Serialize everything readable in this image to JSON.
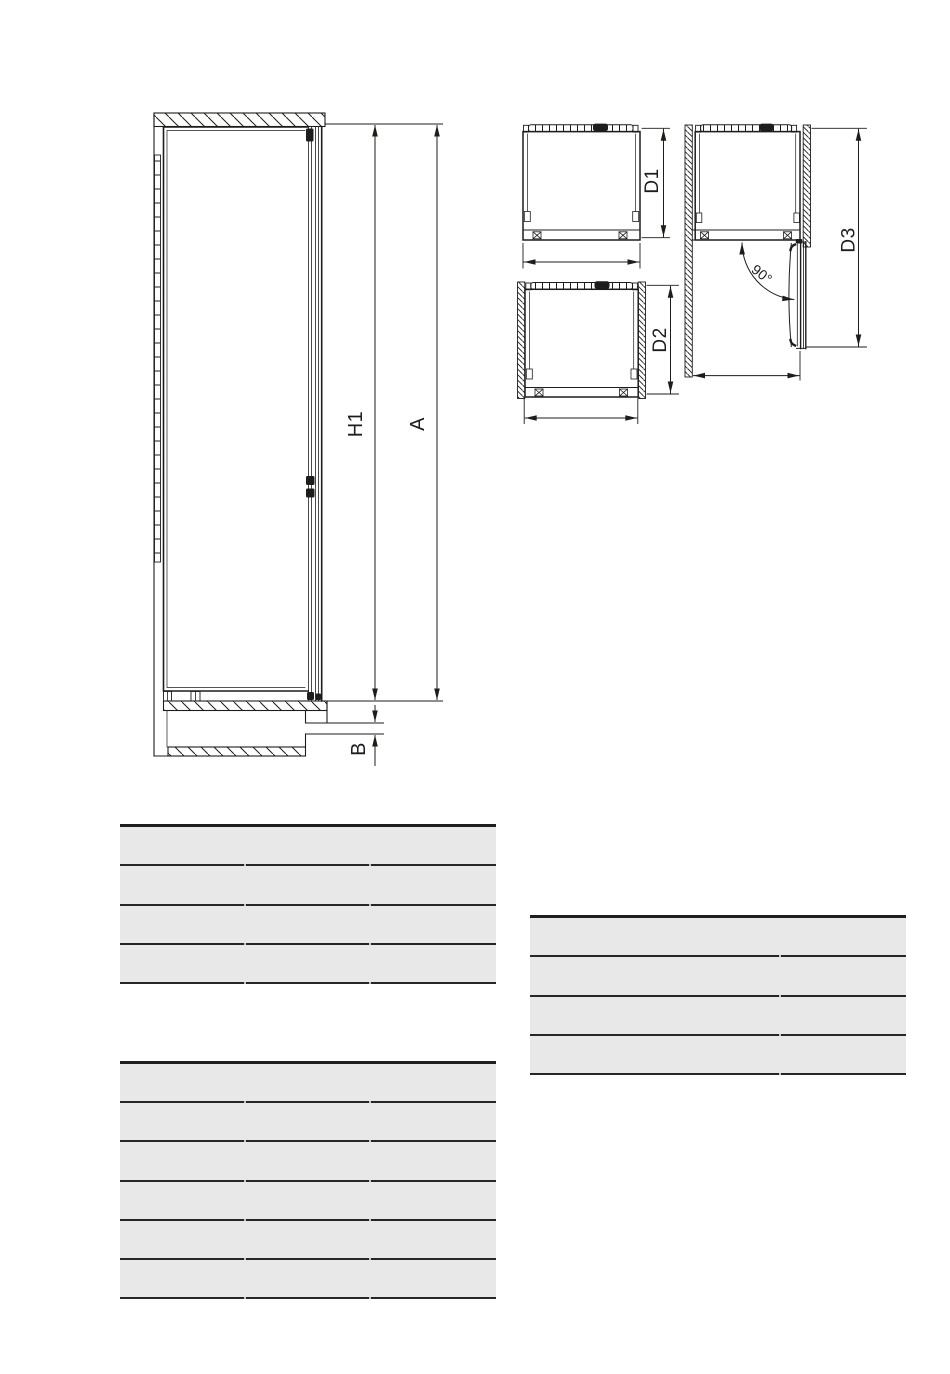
{
  "diagram": {
    "labels": {
      "h1": "H1",
      "a": "A",
      "b": "B",
      "d1": "D1",
      "d2": "D2",
      "d3": "D3",
      "door_angle": "90°"
    }
  },
  "tables": [
    {
      "id": "dimensions-table-1",
      "rows": 4,
      "columns": 3,
      "column_splits": [
        0.333,
        0.665
      ]
    },
    {
      "id": "dimensions-table-2",
      "rows": 4,
      "columns": 2,
      "column_splits": [
        0.665
      ]
    },
    {
      "id": "dimensions-table-3",
      "rows": 6,
      "columns": 3,
      "column_splits": [
        0.333,
        0.665
      ]
    }
  ],
  "colors": {
    "ink": "#1d1d1b",
    "table_row_fill": "#e8e8e8",
    "table_line": "#262626",
    "page_background": "#ffffff"
  }
}
